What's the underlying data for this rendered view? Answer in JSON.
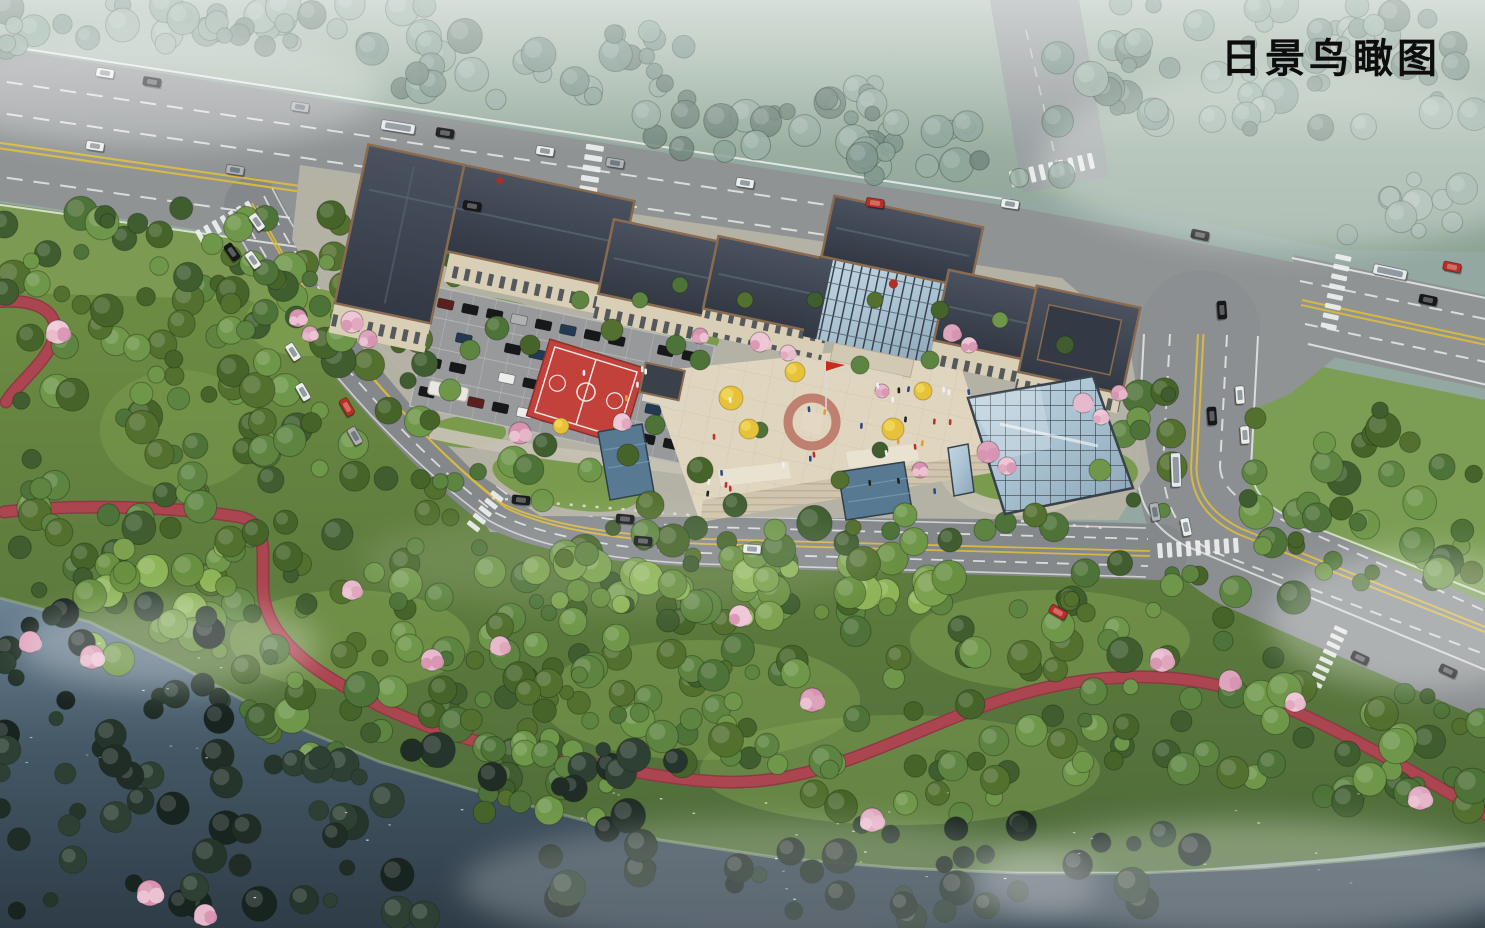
{
  "title": {
    "text": "日景鸟瞰图"
  },
  "palette": {
    "haze_sky": "#a8b9ad",
    "asphalt": "#8f9394",
    "asphalt_dark": "#84888a",
    "lane_white": "#edf0ee",
    "lane_yellow": "#d9b93f",
    "grass": "#6d8c42",
    "grass_dark": "#4e6b39",
    "tree_green": "#4e7338",
    "tree_haze": "#8ea69b",
    "tree_dark": "#26352c",
    "blossom_pink": "#e3aec6",
    "ginkgo_yellow": "#e6c23a",
    "path_red": "#ab4651",
    "court_red": "#c2413b",
    "roof_dark": "#3d4450",
    "roof_trim": "#8a6b50",
    "facade_cream": "#d9cfb6",
    "glass_blue": "#a9c2d2",
    "water_dark": "#2e3c47",
    "water_light": "#6d8496",
    "plaza_tan": "#e0d6c0",
    "canopy_blue": "#587992",
    "flag_red": "#c62a20"
  }
}
